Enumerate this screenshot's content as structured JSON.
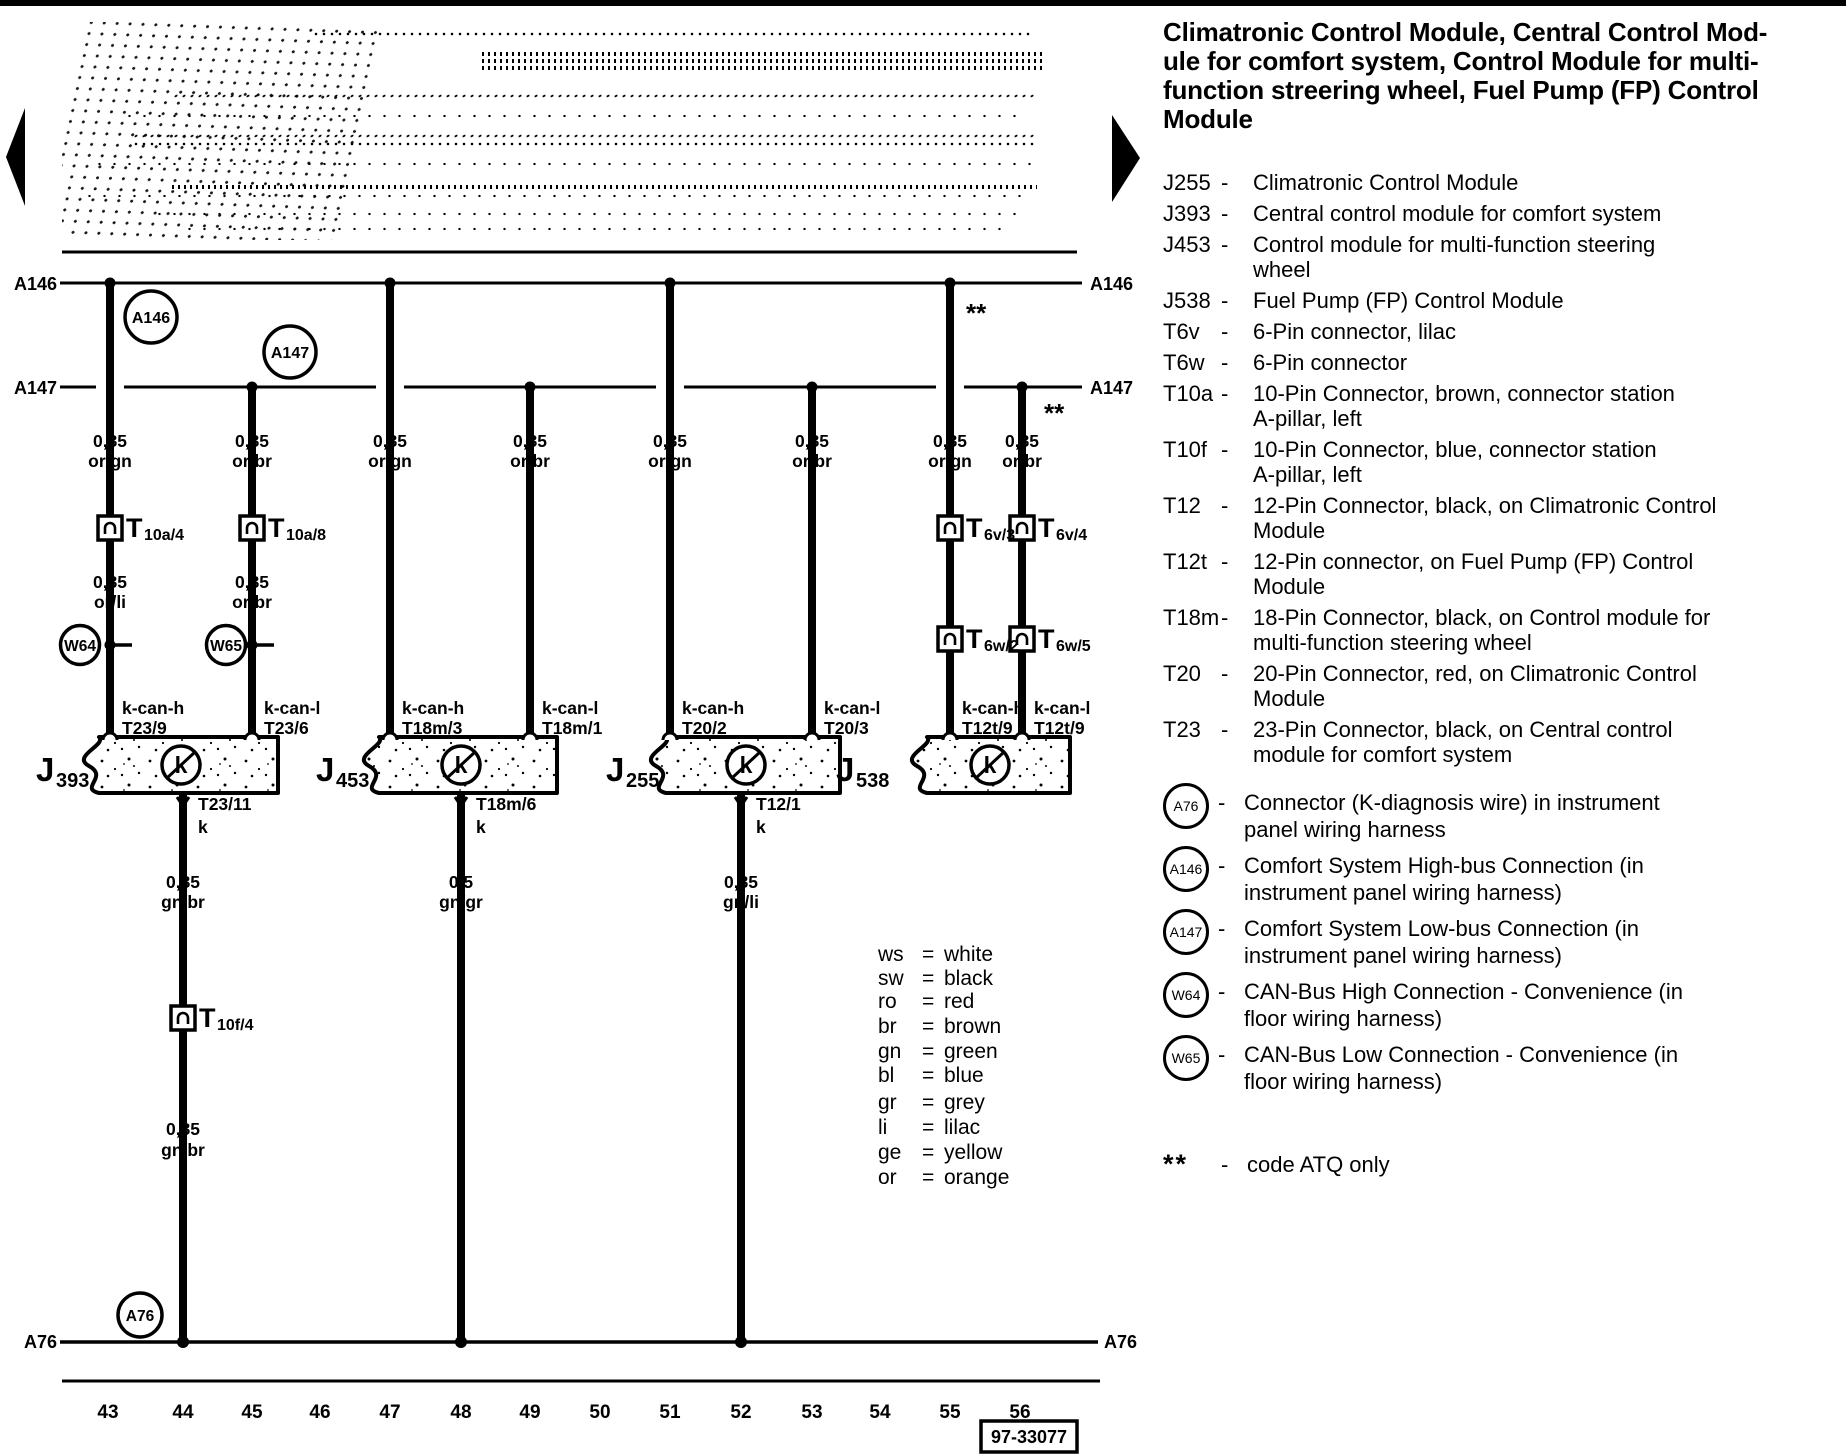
{
  "header": {
    "title_lines": [
      "Climatronic Control Module, Central Control Mod-",
      "ule for comfort system, Control Module for multi-",
      "function streering wheel, Fuel Pump (FP)  Control",
      "Module"
    ]
  },
  "components": [
    {
      "code": "J255",
      "dash": "-",
      "lines": [
        "Climatronic Control Module"
      ]
    },
    {
      "code": "J393",
      "dash": "-",
      "lines": [
        "Central control module for comfort system"
      ]
    },
    {
      "code": "J453",
      "dash": "-",
      "lines": [
        "Control module for multi-function steering",
        "wheel"
      ]
    },
    {
      "code": "J538",
      "dash": "-",
      "lines": [
        "Fuel Pump (FP) Control Module"
      ]
    },
    {
      "code": "T6v",
      "dash": "-",
      "lines": [
        "6-Pin connector, lilac"
      ]
    },
    {
      "code": "T6w",
      "dash": "-",
      "lines": [
        "6-Pin connector"
      ]
    },
    {
      "code": "T10a",
      "dash": "-",
      "lines": [
        "10-Pin Connector, brown, connector station",
        "A-pillar, left"
      ]
    },
    {
      "code": "T10f",
      "dash": "-",
      "lines": [
        "10-Pin Connector, blue, connector station",
        "A-pillar, left"
      ]
    },
    {
      "code": "T12",
      "dash": "-",
      "lines": [
        "12-Pin Connector, black, on Climatronic Control",
        "Module"
      ]
    },
    {
      "code": "T12t",
      "dash": "-",
      "lines": [
        "12-Pin connector, on Fuel Pump (FP) Control",
        "Module"
      ]
    },
    {
      "code": "T18m",
      "dash": "-",
      "lines": [
        "18-Pin Connector, black, on Control module for",
        "multi-function steering wheel"
      ]
    },
    {
      "code": "T20",
      "dash": "-",
      "lines": [
        "20-Pin Connector, red, on Climatronic Control",
        "Module"
      ]
    },
    {
      "code": "T23",
      "dash": "-",
      "lines": [
        "23-Pin Connector, black, on Central control",
        "module for comfort system"
      ]
    }
  ],
  "circle_refs": [
    {
      "code": "A76",
      "dash": "-",
      "lines": [
        "Connector (K-diagnosis wire) in instrument",
        "panel wiring harness"
      ]
    },
    {
      "code": "A146",
      "dash": "-",
      "lines": [
        "Comfort System High-bus Connection (in",
        "instrument panel wiring harness)"
      ]
    },
    {
      "code": "A147",
      "dash": "-",
      "lines": [
        "Comfort System Low-bus Connection (in",
        "instrument panel wiring harness)"
      ]
    },
    {
      "code": "W64",
      "dash": "-",
      "lines": [
        "CAN-Bus High Connection - Convenience (in",
        "floor wiring harness)"
      ]
    },
    {
      "code": "W65",
      "dash": "-",
      "lines": [
        "CAN-Bus Low Connection - Convenience (in",
        "floor wiring harness)"
      ]
    }
  ],
  "footnote": {
    "symbol": "**",
    "dash": "-",
    "text": "code ATQ only"
  },
  "color_legend": [
    {
      "abbr": "ws",
      "name": "white"
    },
    {
      "abbr": "sw",
      "name": "black"
    },
    {
      "abbr": "ro",
      "name": "red"
    },
    {
      "abbr": "br",
      "name": "brown"
    },
    {
      "abbr": "gn",
      "name": "green"
    },
    {
      "abbr": "bl",
      "name": "blue"
    },
    {
      "abbr": "gr",
      "name": "grey"
    },
    {
      "abbr": "li",
      "name": "lilac"
    },
    {
      "abbr": "ge",
      "name": "yellow"
    },
    {
      "abbr": "or",
      "name": "orange"
    }
  ],
  "color_eq": "=",
  "nodes": {
    "a146": "A146",
    "a147": "A147",
    "a76": "A76",
    "w64": "W64",
    "w65": "W65"
  },
  "modules": {
    "j393": {
      "j": "J",
      "n": "393"
    },
    "j453": {
      "j": "J",
      "n": "453"
    },
    "j255": {
      "j": "J",
      "n": "255"
    },
    "j538": {
      "j": "J",
      "n": "538"
    }
  },
  "ksym": "k",
  "connectors": {
    "t10a_4": {
      "t": "T",
      "s": "10a/4"
    },
    "t10a_8": {
      "t": "T",
      "s": "10a/8"
    },
    "t6v_3": {
      "t": "T",
      "s": "6v/3"
    },
    "t6v_4": {
      "t": "T",
      "s": "6v/4"
    },
    "t6w_2": {
      "t": "T",
      "s": "6w/2"
    },
    "t6w_5": {
      "t": "T",
      "s": "6w/5"
    },
    "t10f_4": {
      "t": "T",
      "s": "10f/4"
    }
  },
  "wires": {
    "43": {
      "gauge": "0,35",
      "color": "or/gn",
      "gauge2": "0,35",
      "color2": "or/li",
      "signal": "k-can-h",
      "pin": "T23/9"
    },
    "45": {
      "gauge": "0,35",
      "color": "or/br",
      "gauge2": "0,35",
      "color2": "or/br",
      "signal": "k-can-l",
      "pin": "T23/6"
    },
    "47": {
      "gauge": "0,35",
      "color": "or/gn",
      "signal": "k-can-h",
      "pin": "T18m/3"
    },
    "49": {
      "gauge": "0,35",
      "color": "or/br",
      "signal": "k-can-l",
      "pin": "T18m/1"
    },
    "51": {
      "gauge": "0,35",
      "color": "or/gn",
      "signal": "k-can-h",
      "pin": "T20/2"
    },
    "53": {
      "gauge": "0,35",
      "color": "or/br",
      "signal": "k-can-l",
      "pin": "T20/3"
    },
    "55": {
      "gauge": "0,35",
      "color": "or/gn",
      "signal": "k-can-h",
      "pin": "T12t/9"
    },
    "56": {
      "gauge": "0,35",
      "color": "or/br",
      "signal": "k-can-l",
      "pin": "T12t/9"
    },
    "44": {
      "pin": "T23/11",
      "k": "k",
      "gauge": "0,35",
      "color": "gn/br",
      "gauge2": "0,35",
      "color2": "gn/br"
    },
    "48": {
      "pin": "T18m/6",
      "k": "k",
      "gauge": "0,5",
      "color": "gn/gr"
    },
    "52": {
      "pin": "T12/1",
      "k": "k",
      "gauge": "0,35",
      "color": "gn/li"
    }
  },
  "tracks": [
    "43",
    "44",
    "45",
    "46",
    "47",
    "48",
    "49",
    "50",
    "51",
    "52",
    "53",
    "54",
    "55",
    "56"
  ],
  "figure_number": "97-33077"
}
